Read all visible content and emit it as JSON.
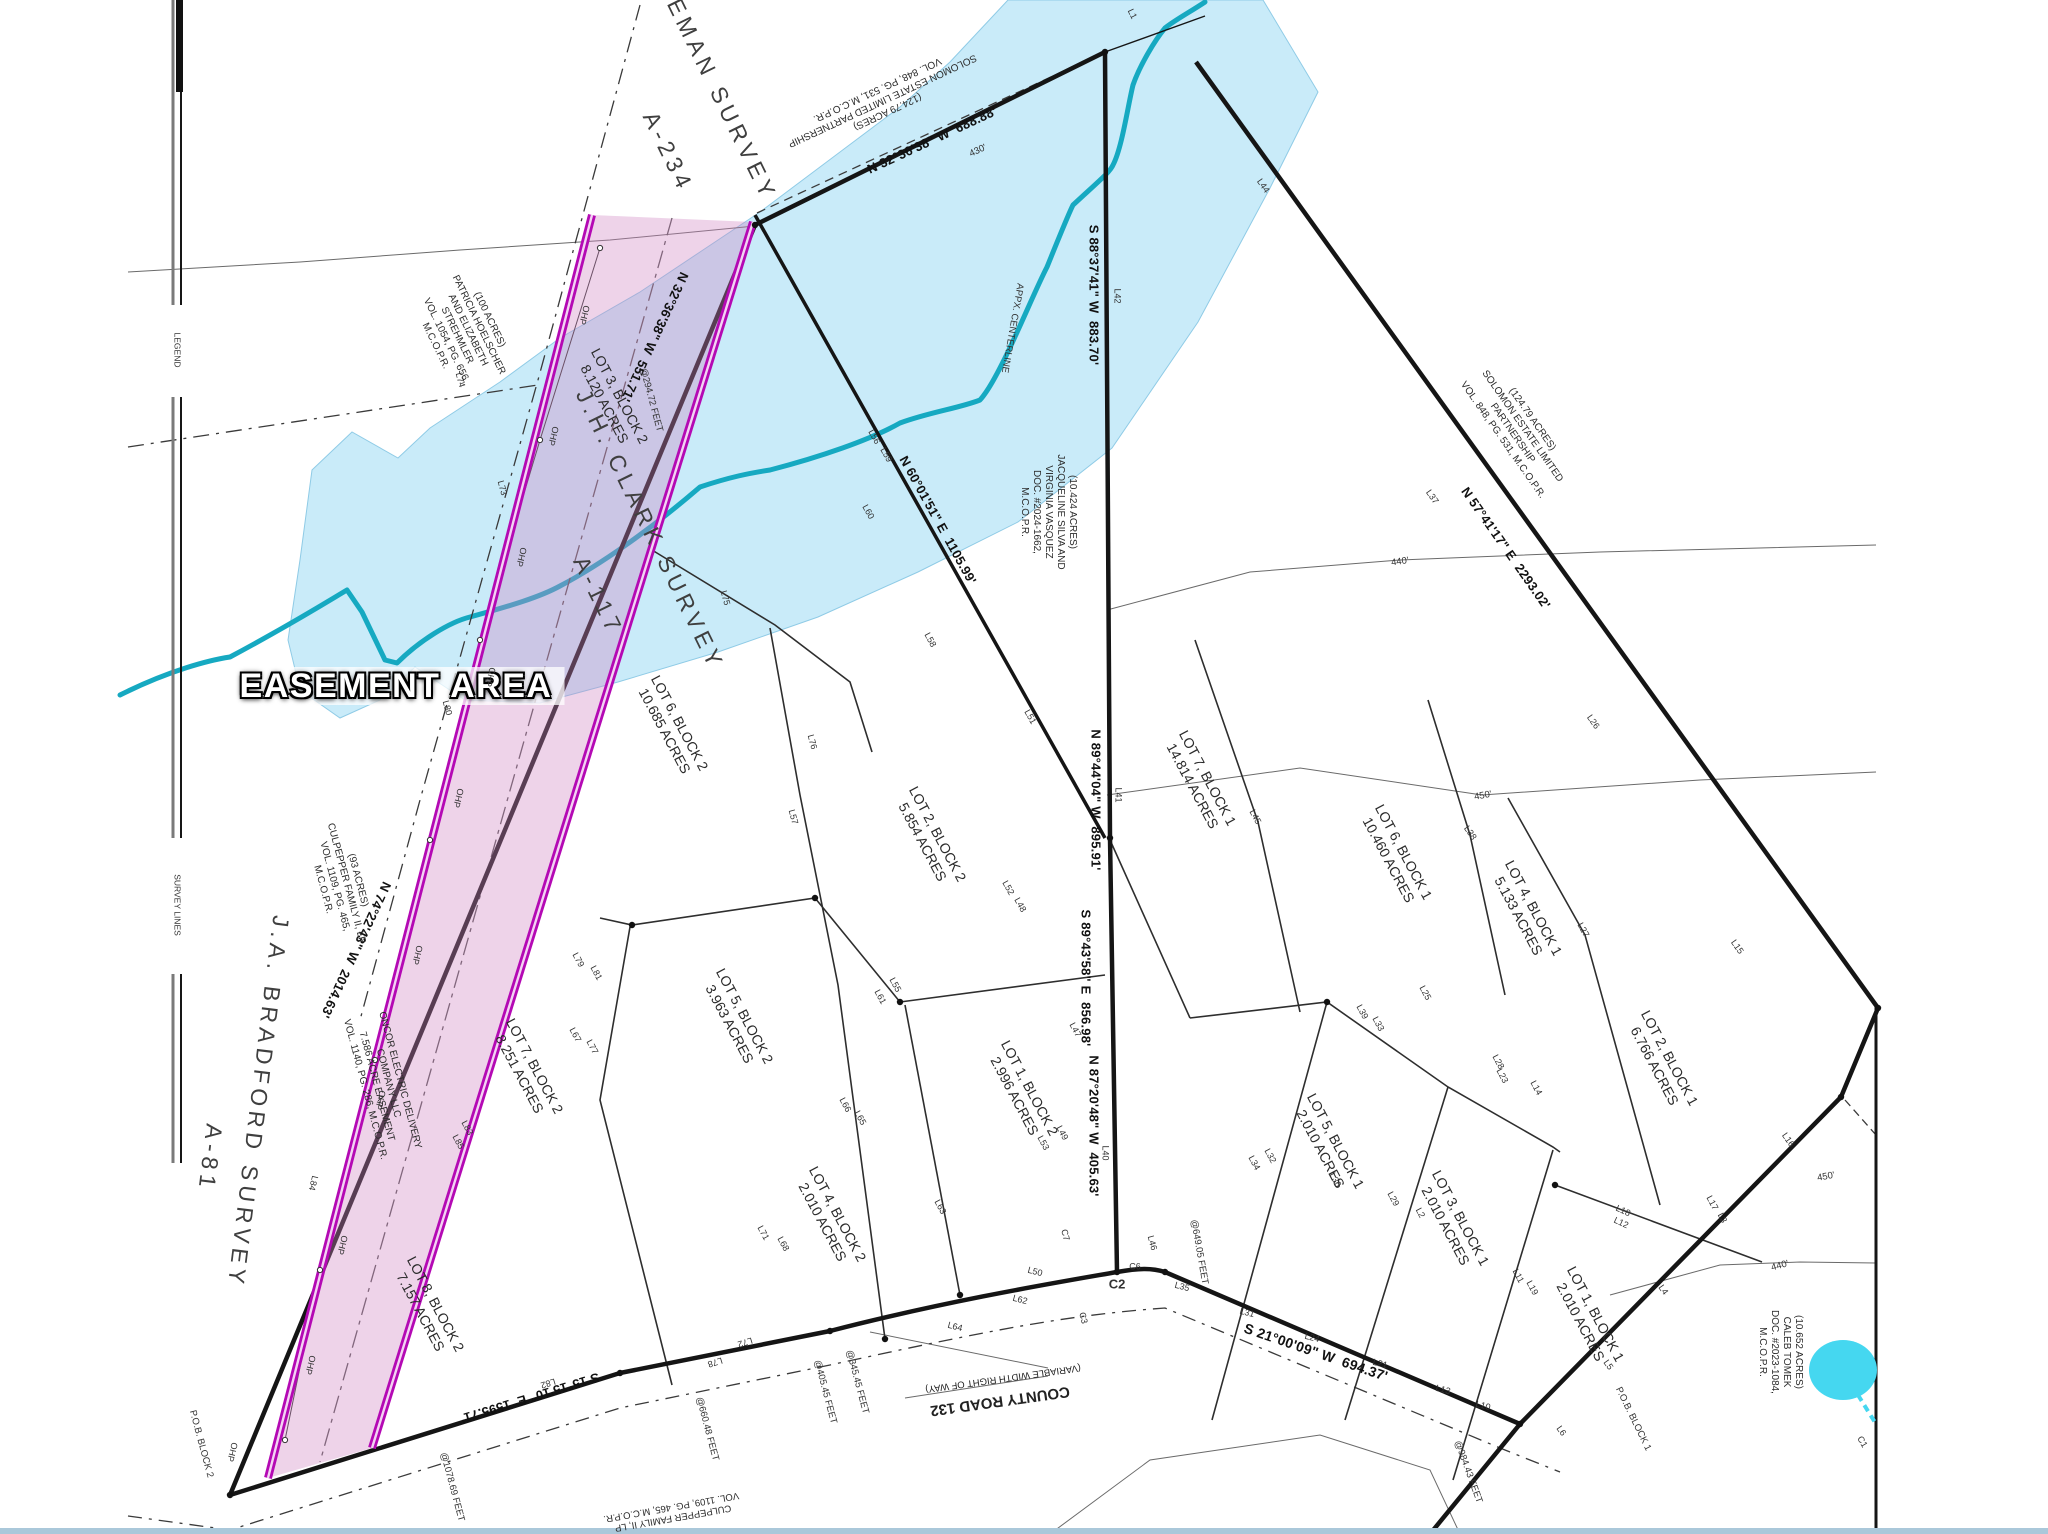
{
  "colors": {
    "flood": "#c9ebf9",
    "flood_edge": "#8fcbe6",
    "creek": "#16a9c1",
    "easement": "#b409b4",
    "easement_inner": "#f3d4f3",
    "easement_fill": "#d086c2",
    "pond": "#45d7f0",
    "heavy_line": "#151515",
    "bottom_bar": "#aac8da"
  },
  "easement_title": "EASEMENT AREA",
  "labels": [
    {
      "t": "EASEMENT AREA",
      "x": 396,
      "y": 686,
      "r": 0,
      "s": 34,
      "w": 800,
      "cls": "easement-title",
      "n": "easement-area-title"
    },
    {
      "t": "LEMAN SURVEY",
      "x": 718,
      "y": 92,
      "r": 64,
      "s": 23,
      "ls": 5,
      "cls": "survey",
      "n": "survey-name-leman"
    },
    {
      "t": "A-234",
      "x": 668,
      "y": 152,
      "r": 64,
      "s": 23,
      "ls": 5,
      "cls": "survey",
      "n": "survey-abstract-leman"
    },
    {
      "t": "J.H. CLARK SURVEY",
      "x": 650,
      "y": 530,
      "r": 64,
      "s": 23,
      "ls": 5,
      "cls": "survey",
      "n": "survey-name-clark"
    },
    {
      "t": "A-117",
      "x": 598,
      "y": 596,
      "r": 64,
      "s": 23,
      "ls": 5,
      "cls": "survey",
      "n": "survey-abstract-clark"
    },
    {
      "t": "J.A. BRADFORD SURVEY",
      "x": 258,
      "y": 1102,
      "r": 97,
      "s": 23,
      "ls": 5,
      "cls": "survey",
      "n": "survey-name-bradford"
    },
    {
      "t": "A-81",
      "x": 210,
      "y": 1158,
      "r": 97,
      "s": 23,
      "ls": 5,
      "cls": "survey",
      "n": "survey-abstract-bradford"
    },
    {
      "t": "N 32°36'38\" W  551.71'",
      "x": 655,
      "y": 337,
      "r": 115,
      "s": 13,
      "cls": "bearing",
      "n": "bearing-label"
    },
    {
      "t": "N 32°36'38\" W  688.88'",
      "x": 932,
      "y": 140,
      "r": -25,
      "s": 13,
      "cls": "bearing",
      "n": "bearing-label"
    },
    {
      "t": "S 88°37'41\" W  883.70'",
      "x": 1094,
      "y": 295,
      "r": 90,
      "s": 13,
      "cls": "bearing",
      "n": "bearing-label"
    },
    {
      "t": "N 60°01'51\" E  1105.99'",
      "x": 938,
      "y": 520,
      "r": 61,
      "s": 13,
      "cls": "bearing",
      "n": "bearing-label"
    },
    {
      "t": "N 89°44'04\" W  895.91'",
      "x": 1096,
      "y": 800,
      "r": 90,
      "s": 13,
      "cls": "bearing",
      "n": "bearing-label"
    },
    {
      "t": "S 89°43'58\" E  856.98'",
      "x": 1086,
      "y": 978,
      "r": 90,
      "s": 13,
      "cls": "bearing",
      "n": "bearing-label"
    },
    {
      "t": "N 87°20'48\" W  405.63'",
      "x": 1094,
      "y": 1126,
      "r": 90,
      "s": 13,
      "cls": "bearing",
      "n": "bearing-label"
    },
    {
      "t": "N 57°41'17\" E  2293.02'",
      "x": 1506,
      "y": 548,
      "r": 55,
      "s": 13,
      "cls": "bearing",
      "n": "bearing-label"
    },
    {
      "t": "S 21°00'09\" W  694.37'",
      "x": 1316,
      "y": 1352,
      "r": 19,
      "s": 14,
      "cls": "bearing",
      "n": "bearing-label"
    },
    {
      "t": "S 15°15'10\" E  1595.71'",
      "x": 530,
      "y": 1398,
      "r": 163,
      "s": 13,
      "cls": "bearing",
      "n": "bearing-label"
    },
    {
      "t": "N 74°22'43\" W  2014.63'",
      "x": 356,
      "y": 950,
      "r": 115,
      "s": 13,
      "cls": "bearing",
      "n": "bearing-label"
    },
    {
      "t": "COUNTY ROAD 132",
      "x": 1000,
      "y": 1401,
      "r": 172,
      "s": 15,
      "w": 600,
      "n": "road-name-label"
    },
    {
      "t": "(VARIABLE WIDTH RIGHT OF WAY)",
      "x": 1003,
      "y": 1378,
      "r": 172,
      "s": 9.5,
      "n": "road-row-label"
    },
    {
      "t": "APPX. CENTERLINE",
      "x": 1012,
      "y": 328,
      "r": 100,
      "s": 9.5,
      "cls": "tiny",
      "n": "creek-centerline-label"
    },
    {
      "t": "@294.72 FEET",
      "x": 651,
      "y": 400,
      "r": 75,
      "s": 9.5,
      "cls": "tiny",
      "n": "feet-label"
    },
    {
      "t": "@1078.69 FEET",
      "x": 452,
      "y": 1487,
      "r": 75,
      "s": 9.5,
      "cls": "tiny",
      "n": "feet-label"
    },
    {
      "t": "@660.48 FEET",
      "x": 707,
      "y": 1429,
      "r": 75,
      "s": 9.5,
      "cls": "tiny",
      "n": "feet-label"
    },
    {
      "t": "@405.45 FEET",
      "x": 825,
      "y": 1392,
      "r": 75,
      "s": 9.5,
      "cls": "tiny",
      "n": "feet-label"
    },
    {
      "t": "@345.45 FEET",
      "x": 857,
      "y": 1382,
      "r": 75,
      "s": 9.5,
      "cls": "tiny",
      "n": "feet-label"
    },
    {
      "t": "@649.05 FEET",
      "x": 1199,
      "y": 1252,
      "r": 80,
      "s": 9.5,
      "cls": "tiny",
      "n": "feet-label"
    },
    {
      "t": "@984.43 FEET",
      "x": 1468,
      "y": 1472,
      "r": 70,
      "s": 9.5,
      "cls": "tiny",
      "n": "feet-label"
    },
    {
      "t": "P.O.B. BLOCK 2",
      "x": 201,
      "y": 1444,
      "r": 75,
      "s": 9.5,
      "cls": "tiny",
      "n": "pob-block2-label"
    },
    {
      "t": "P.O.B. BLOCK 1",
      "x": 1633,
      "y": 1419,
      "r": 64,
      "s": 9.5,
      "cls": "tiny",
      "n": "pob-block1-label"
    },
    {
      "t": "LEGEND",
      "x": 177,
      "y": 350,
      "r": 90,
      "s": 8.5,
      "cls": "tiny",
      "n": "legend-edge-label"
    },
    {
      "t": "SURVEY LINES",
      "x": 177,
      "y": 905,
      "r": 90,
      "s": 8.5,
      "cls": "tiny",
      "n": "legend-edge-label"
    },
    {
      "t": "430'",
      "x": 978,
      "y": 151,
      "r": -25,
      "s": 9.5,
      "cls": "tiny",
      "n": "contour-label"
    },
    {
      "t": "440'",
      "x": 1400,
      "y": 562,
      "r": -8,
      "s": 9.5,
      "cls": "tiny",
      "n": "contour-label"
    },
    {
      "t": "450'",
      "x": 1483,
      "y": 796,
      "r": -10,
      "s": 9.5,
      "cls": "tiny",
      "n": "contour-label"
    },
    {
      "t": "450'",
      "x": 1826,
      "y": 1177,
      "r": -10,
      "s": 9.5,
      "cls": "tiny",
      "n": "contour-label"
    },
    {
      "t": "440'",
      "x": 1780,
      "y": 1266,
      "r": -15,
      "s": 9.5,
      "cls": "tiny",
      "n": "contour-label"
    },
    {
      "t": "OHP",
      "x": 584,
      "y": 315,
      "r": 104,
      "s": 9,
      "cls": "tiny",
      "n": "ohp-label"
    },
    {
      "t": "OHP",
      "x": 553,
      "y": 436,
      "r": 104,
      "s": 9,
      "cls": "tiny",
      "n": "ohp-label"
    },
    {
      "t": "OHP",
      "x": 521,
      "y": 557,
      "r": 104,
      "s": 9,
      "cls": "tiny",
      "n": "ohp-label"
    },
    {
      "t": "OHP",
      "x": 490,
      "y": 677,
      "r": 104,
      "s": 9,
      "cls": "tiny",
      "n": "ohp-label"
    },
    {
      "t": "OHP",
      "x": 458,
      "y": 798,
      "r": 104,
      "s": 9,
      "cls": "tiny",
      "n": "ohp-label"
    },
    {
      "t": "OHP",
      "x": 417,
      "y": 955,
      "r": 104,
      "s": 9,
      "cls": "tiny",
      "n": "ohp-label"
    },
    {
      "t": "OHP",
      "x": 380,
      "y": 1100,
      "r": 104,
      "s": 9,
      "cls": "tiny",
      "n": "ohp-label"
    },
    {
      "t": "OHP",
      "x": 342,
      "y": 1245,
      "r": 104,
      "s": 9,
      "cls": "tiny",
      "n": "ohp-label"
    },
    {
      "t": "OHP",
      "x": 310,
      "y": 1365,
      "r": 104,
      "s": 9,
      "cls": "tiny",
      "n": "ohp-label"
    },
    {
      "t": "OHP",
      "x": 232,
      "y": 1452,
      "r": 104,
      "s": 9,
      "cls": "tiny",
      "n": "ohp-label"
    }
  ],
  "line_labels": [
    [
      "L1",
      1132,
      14,
      64
    ],
    [
      "L42",
      1117,
      296,
      90
    ],
    [
      "L44",
      1263,
      186,
      55
    ],
    [
      "L37",
      1432,
      497,
      55
    ],
    [
      "L59",
      886,
      455,
      61
    ],
    [
      "L60",
      868,
      512,
      61
    ],
    [
      "L56",
      874,
      437,
      61
    ],
    [
      "L75",
      725,
      598,
      75
    ],
    [
      "L76",
      812,
      742,
      75
    ],
    [
      "L51",
      1030,
      717,
      61
    ],
    [
      "L52",
      1008,
      888,
      61
    ],
    [
      "L48",
      1020,
      905,
      61
    ],
    [
      "L41",
      1118,
      795,
      90
    ],
    [
      "L45",
      1255,
      817,
      62
    ],
    [
      "L46",
      1152,
      1243,
      75
    ],
    [
      "L40",
      1105,
      1153,
      90
    ],
    [
      "L47",
      1075,
      1030,
      62
    ],
    [
      "L38",
      1470,
      833,
      55
    ],
    [
      "L26",
      1593,
      722,
      55
    ],
    [
      "L27",
      1583,
      930,
      62
    ],
    [
      "L15",
      1737,
      947,
      55
    ],
    [
      "L39",
      1362,
      1012,
      62
    ],
    [
      "L33",
      1378,
      1024,
      62
    ],
    [
      "L25",
      1425,
      993,
      62
    ],
    [
      "L28",
      1498,
      1062,
      62
    ],
    [
      "L23",
      1502,
      1076,
      62
    ],
    [
      "L14",
      1536,
      1088,
      62
    ],
    [
      "L36",
      1335,
      1180,
      62
    ],
    [
      "L29",
      1393,
      1199,
      62
    ],
    [
      "L2",
      1420,
      1213,
      62
    ],
    [
      "L32",
      1270,
      1156,
      62
    ],
    [
      "L34",
      1254,
      1163,
      62
    ],
    [
      "L11",
      1518,
      1276,
      62
    ],
    [
      "L19",
      1532,
      1288,
      62
    ],
    [
      "L18",
      1623,
      1211,
      25
    ],
    [
      "L12",
      1621,
      1223,
      25
    ],
    [
      "L17",
      1712,
      1203,
      62
    ],
    [
      "L3",
      1722,
      1218,
      62
    ],
    [
      "L16",
      1788,
      1140,
      55
    ],
    [
      "L4",
      1663,
      1290,
      55
    ],
    [
      "L5",
      1608,
      1365,
      55
    ],
    [
      "L6",
      1561,
      1431,
      55
    ],
    [
      "L35",
      1182,
      1287,
      15
    ],
    [
      "L31",
      1247,
      1313,
      15
    ],
    [
      "L24",
      1312,
      1338,
      15
    ],
    [
      "L21",
      1380,
      1364,
      15
    ],
    [
      "L13",
      1443,
      1390,
      15
    ],
    [
      "L10",
      1483,
      1406,
      15
    ],
    [
      "L50",
      1035,
      1272,
      15
    ],
    [
      "C2",
      1117,
      1284,
      0
    ],
    [
      "C6",
      1135,
      1267,
      0
    ],
    [
      "C7",
      1065,
      1235,
      75
    ],
    [
      "C3",
      1083,
      1318,
      75
    ],
    [
      "C1",
      1862,
      1442,
      60
    ],
    [
      "L49",
      1062,
      1133,
      62
    ],
    [
      "L53",
      1043,
      1143,
      62
    ],
    [
      "L63",
      940,
      1207,
      62
    ],
    [
      "L62",
      1020,
      1300,
      15
    ],
    [
      "L64",
      955,
      1327,
      15
    ],
    [
      "L66",
      845,
      1105,
      62
    ],
    [
      "L65",
      860,
      1118,
      62
    ],
    [
      "L71",
      763,
      1233,
      62
    ],
    [
      "L68",
      783,
      1244,
      62
    ],
    [
      "L67",
      575,
      1035,
      62
    ],
    [
      "L77",
      592,
      1047,
      62
    ],
    [
      "L79",
      578,
      960,
      62
    ],
    [
      "L81",
      596,
      973,
      62
    ],
    [
      "L55",
      895,
      985,
      62
    ],
    [
      "L61",
      880,
      997,
      62
    ],
    [
      "L73",
      502,
      488,
      75
    ],
    [
      "L74",
      460,
      380,
      75
    ],
    [
      "L80",
      447,
      708,
      75
    ],
    [
      "L82",
      548,
      1383,
      163
    ],
    [
      "L78",
      715,
      1362,
      163
    ],
    [
      "L72",
      745,
      1342,
      163
    ],
    [
      "L84",
      313,
      1183,
      104
    ],
    [
      "L83",
      467,
      1128,
      62
    ],
    [
      "L85",
      458,
      1142,
      62
    ],
    [
      "L57",
      793,
      817,
      75
    ],
    [
      "L58",
      930,
      640,
      62
    ]
  ],
  "blocks": [
    {
      "lines": [
        "LOT 3, BLOCK 2",
        "8.120 ACRES"
      ],
      "x": 612,
      "y": 400,
      "r": 62,
      "s": 14,
      "n": "lot-label"
    },
    {
      "lines": [
        "LOT 6, BLOCK 2",
        "10.685 ACRES"
      ],
      "x": 672,
      "y": 727,
      "r": 62,
      "s": 14,
      "n": "lot-label"
    },
    {
      "lines": [
        "LOT 2, BLOCK 2",
        "5.854 ACRES"
      ],
      "x": 930,
      "y": 838,
      "r": 62,
      "s": 14,
      "n": "lot-label"
    },
    {
      "lines": [
        "LOT 5, BLOCK 2",
        "3.963 ACRES"
      ],
      "x": 737,
      "y": 1020,
      "r": 62,
      "s": 14,
      "n": "lot-label"
    },
    {
      "lines": [
        "LOT 1, BLOCK 2",
        "2.996 ACRES"
      ],
      "x": 1022,
      "y": 1092,
      "r": 62,
      "s": 14,
      "n": "lot-label"
    },
    {
      "lines": [
        "LOT 4, BLOCK 2",
        "2.010 ACRES"
      ],
      "x": 830,
      "y": 1218,
      "r": 62,
      "s": 14,
      "n": "lot-label"
    },
    {
      "lines": [
        "LOT 7, BLOCK 2",
        "8.251 ACRES"
      ],
      "x": 527,
      "y": 1070,
      "r": 62,
      "s": 14,
      "n": "lot-label"
    },
    {
      "lines": [
        "LOT 8, BLOCK 2",
        "7.157 ACRES"
      ],
      "x": 428,
      "y": 1308,
      "r": 62,
      "s": 14,
      "n": "lot-label"
    },
    {
      "lines": [
        "LOT 7, BLOCK 1",
        "14.814 ACRES"
      ],
      "x": 1200,
      "y": 782,
      "r": 62,
      "s": 14,
      "n": "lot-label"
    },
    {
      "lines": [
        "LOT 6, BLOCK 1",
        "10.460 ACRES"
      ],
      "x": 1396,
      "y": 856,
      "r": 62,
      "s": 14,
      "n": "lot-label"
    },
    {
      "lines": [
        "LOT 4, BLOCK 1",
        "5.133 ACRES"
      ],
      "x": 1526,
      "y": 912,
      "r": 62,
      "s": 14,
      "n": "lot-label"
    },
    {
      "lines": [
        "LOT 2, BLOCK 1",
        "6.766 ACRES"
      ],
      "x": 1662,
      "y": 1062,
      "r": 62,
      "s": 14,
      "n": "lot-label"
    },
    {
      "lines": [
        "LOT 5, BLOCK 1",
        "2.010 ACRES"
      ],
      "x": 1328,
      "y": 1145,
      "r": 62,
      "s": 14,
      "n": "lot-label"
    },
    {
      "lines": [
        "LOT 3, BLOCK 1",
        "2.010 ACRES"
      ],
      "x": 1453,
      "y": 1222,
      "r": 62,
      "s": 14,
      "n": "lot-label"
    },
    {
      "lines": [
        "LOT 1, BLOCK 1",
        "2.010 ACRES"
      ],
      "x": 1588,
      "y": 1318,
      "r": 62,
      "s": 14,
      "n": "lot-label"
    },
    {
      "lines": [
        "(124.79 ACRES)",
        "SOLOMON ESTATE LIMITED PARTNERSHIP",
        "VOL. 848, PG. 531, M.C.O.P.R."
      ],
      "x": 882,
      "y": 100,
      "r": 155,
      "s": 10,
      "n": "owner-label"
    },
    {
      "lines": [
        "(100 ACRES)",
        "PATRICIA HOELSCHER",
        "AND ELIZABETH",
        "STREHMLER",
        "VOL. 1054, PG. 656,",
        "M.C.O.P.R."
      ],
      "x": 462,
      "y": 333,
      "r": 64,
      "s": 10,
      "n": "owner-label"
    },
    {
      "lines": [
        "(10.424 ACRES)",
        "JACQUELINE SILVA AND",
        "VIRGINIA VASQUEZ",
        "DOC. #2024-1662,",
        "M.C.O.P.R."
      ],
      "x": 1048,
      "y": 512,
      "r": 90,
      "s": 10,
      "n": "owner-label"
    },
    {
      "lines": [
        "(124.79 ACRES)",
        "SOLOMON ESTATE LIMITED",
        "PARTNERSHIP",
        "VOL. 848, PG. 531, M.C.O.P.R."
      ],
      "x": 1517,
      "y": 430,
      "r": 55,
      "s": 10,
      "n": "owner-label"
    },
    {
      "lines": [
        "(93 ACRES)",
        "CULPEPPER FAMILY II, LP",
        "VOL. 1109, PG. 465,",
        "M.C.O.P.R."
      ],
      "x": 340,
      "y": 885,
      "r": 75,
      "s": 10,
      "n": "owner-label"
    },
    {
      "lines": [
        "ONCOR ELECTRIC DELIVERY",
        "COMPANY LLC",
        "7.586 ACRE EASEMENT",
        "VOL. 1140, PG. 286, M.C.O.P.R."
      ],
      "x": 382,
      "y": 1085,
      "r": 75,
      "s": 10,
      "n": "oncor-easement-label"
    },
    {
      "lines": [
        "(10.652 ACRES)",
        "CALEB TOMEK",
        "DOC. #2023-1084,",
        "M.C.O.P.R."
      ],
      "x": 1780,
      "y": 1352,
      "r": 90,
      "s": 10,
      "n": "owner-label"
    },
    {
      "lines": [
        "CULPEPPER FAMILY II, LP",
        "VOL. 1109, PG. 465, M.C.O.P.R."
      ],
      "x": 672,
      "y": 1512,
      "r": 170,
      "s": 9.5,
      "n": "owner-label"
    }
  ],
  "vertex_dots": [
    [
      755,
      225
    ],
    [
      1105,
      52
    ],
    [
      1110,
      838
    ],
    [
      1117,
      1272
    ],
    [
      1165,
      1272
    ],
    [
      230,
      1495
    ],
    [
      1878,
      1008
    ],
    [
      1841,
      1097
    ],
    [
      1520,
      1424
    ],
    [
      632,
      925
    ],
    [
      900,
      1002
    ],
    [
      1327,
      1002
    ],
    [
      1555,
      1185
    ],
    [
      815,
      898
    ],
    [
      885,
      1339
    ],
    [
      960,
      1295
    ],
    [
      620,
      1373
    ],
    [
      830,
      1331
    ]
  ],
  "ohp_poles": [
    [
      600,
      248
    ],
    [
      540,
      440
    ],
    [
      480,
      640
    ],
    [
      430,
      840
    ],
    [
      375,
      1060
    ],
    [
      320,
      1270
    ],
    [
      285,
      1440
    ]
  ]
}
